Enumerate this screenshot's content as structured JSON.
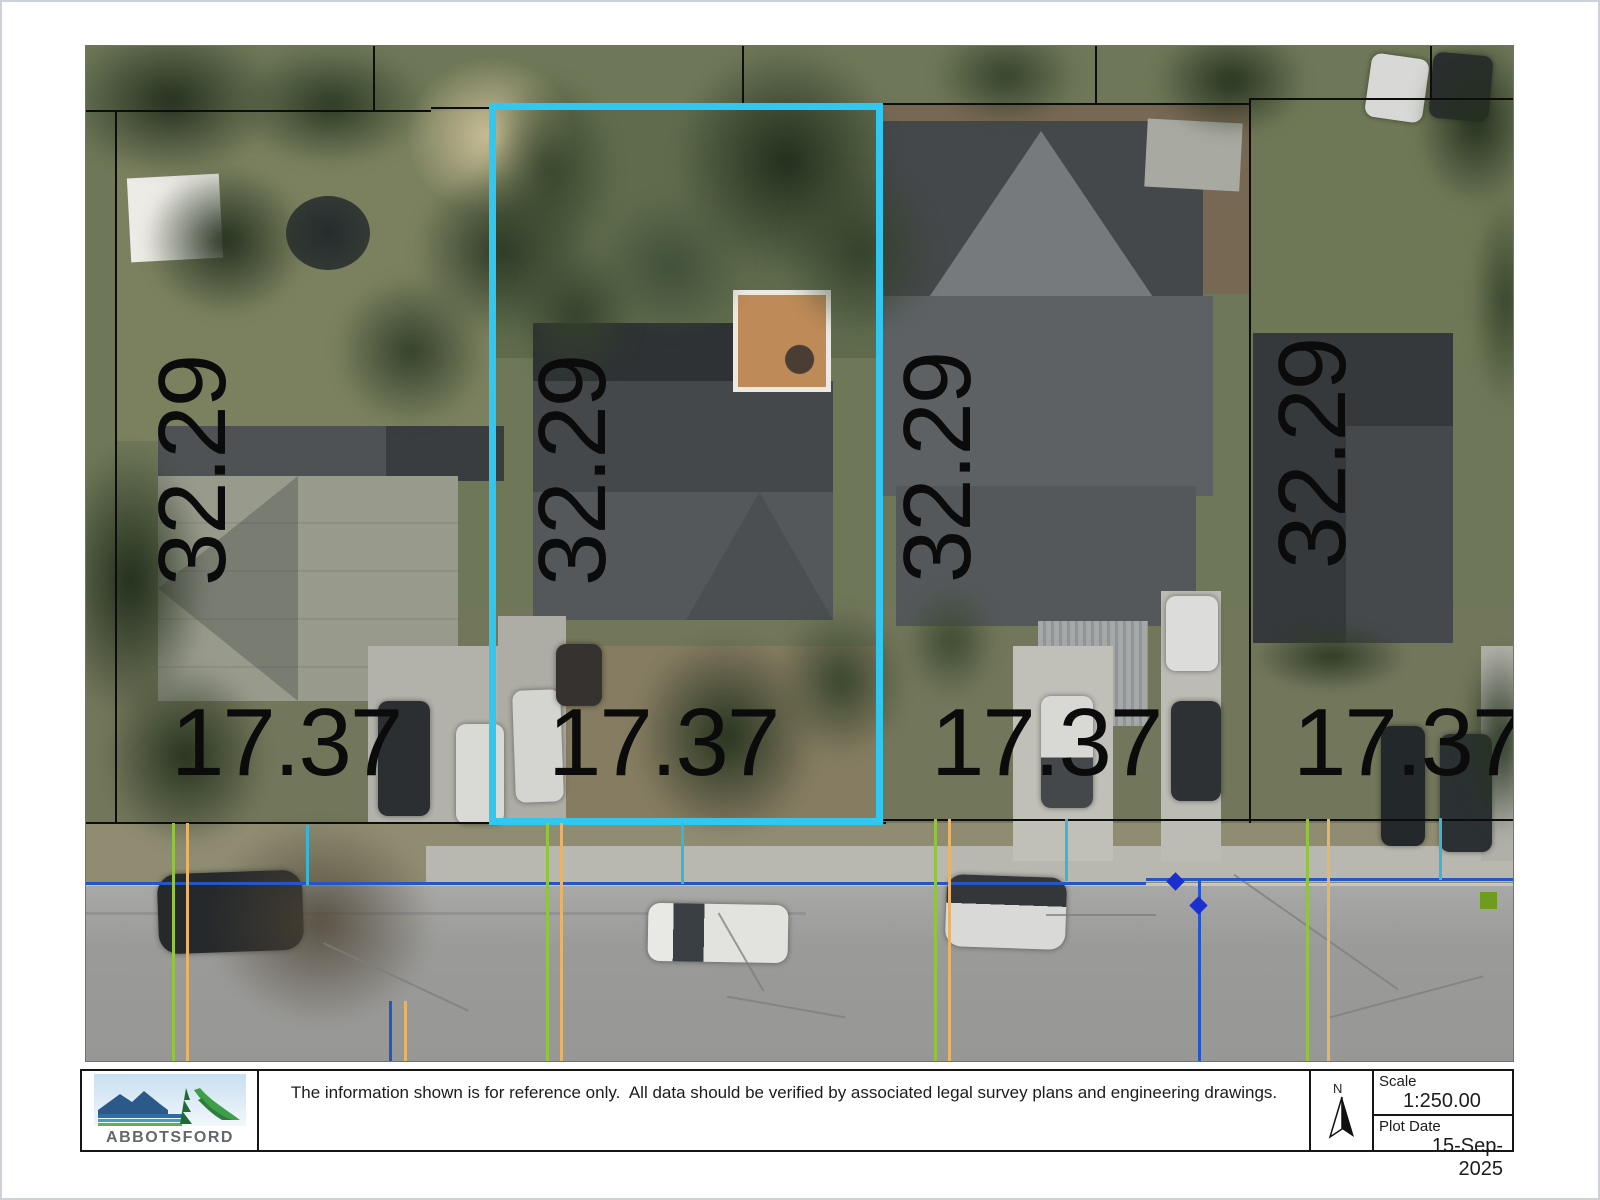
{
  "map": {
    "highlight_color": "#31c7ef",
    "depth_labels": [
      "32.29",
      "32.29",
      "32.29",
      "32.29"
    ],
    "frontage_labels": [
      "17.37",
      "17.37",
      "17.37",
      "17.37"
    ],
    "marker_colors": {
      "diamond": "#1a2fd0",
      "square": "#6f9c1d",
      "blue_line": "#2456c9",
      "teal_line": "#3ab5d6",
      "green_line": "#93c43f",
      "orange_line": "#e7b469"
    }
  },
  "footer": {
    "logo": {
      "text": "ABBOTSFORD"
    },
    "disclaimer": "The information shown is for reference only.  All data should be verified by associated legal survey plans and engineering drawings.",
    "north": {
      "label": "N"
    },
    "scale": {
      "label": "Scale",
      "value": "1:250.00"
    },
    "plot_date": {
      "label": "Plot Date",
      "value": "15-Sep-2025"
    }
  }
}
